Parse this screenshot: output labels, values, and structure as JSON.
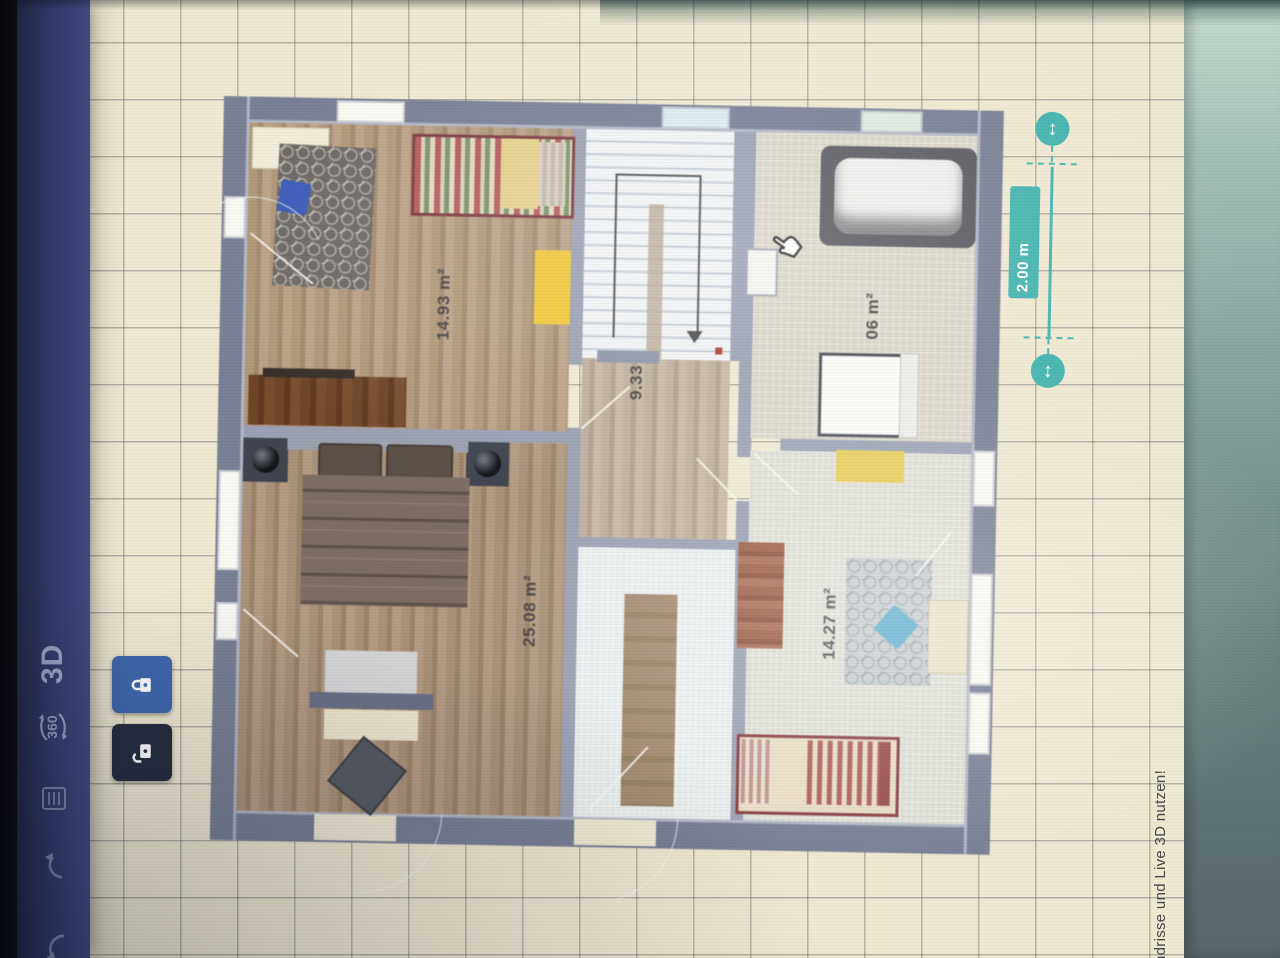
{
  "toolbar": {
    "view3d_label": "3D",
    "rotate_label": "360"
  },
  "floorplan": {
    "rooms": [
      {
        "name": "bedroom-top-left",
        "area_label": "14.93 m²"
      },
      {
        "name": "bedroom-main",
        "area_label": "25.08 m²"
      },
      {
        "name": "stair-hall",
        "area_label": "9.33"
      },
      {
        "name": "bathroom",
        "area_label": "06 m²"
      },
      {
        "name": "bedroom-bottom-right",
        "area_label": "14.27 m²"
      }
    ]
  },
  "dimension": {
    "label": "2.00 m"
  },
  "status": {
    "message": "ndrisse und Live 3D nutzen!"
  },
  "colors": {
    "accent_teal": "#45b5b0",
    "toolbar_blue": "#39437a",
    "lock_active_blue": "#4068ae",
    "lock_inactive_dark": "#272e40"
  }
}
